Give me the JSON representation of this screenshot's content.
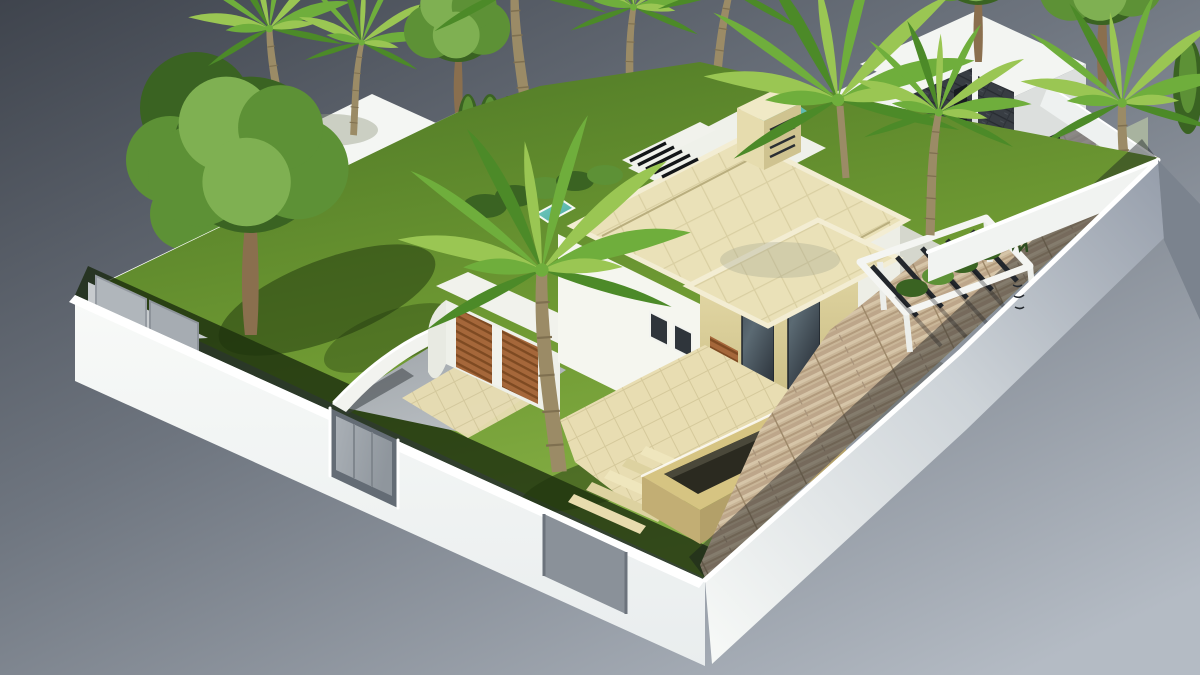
{
  "scene": {
    "alt": "Aerial isometric 3D architectural rendering of a modern Mediterranean villa plot: cream limestone villa with flat roofs, front lawn with palm trees, curved driveway to twin wooden garage doors, stone entry steps, raised stone water trough, long plank-paved driveway with white pergola, all enclosed by a white perimeter wall; white neighbouring houses with dark slate accents and many palms behind, floating on a grey studio gradient background"
  },
  "colors": {
    "bg_top_left": "#3f444d",
    "bg_mid": "#6e757f",
    "bg_bottom_right": "#b4bbc4",
    "perimeter_wall": "#f8faf8",
    "wall_shadow_face": "#959daa",
    "wall_top_highlight": "#ffffff",
    "inner_wall_face": "#dde2e6",
    "lawn_dark": "#4e7826",
    "lawn_light": "#8cb54a",
    "cast_shadow_green": "#16250b",
    "concrete_drive": "#b9bec2",
    "stone_paving": "#e8ddb2",
    "plank_paving": "#c9b698",
    "villa_render_white": "#f5f6ef",
    "villa_render_shade": "#e4e5d9",
    "limestone": "#e7dcab",
    "limestone_shade": "#c9bc83",
    "roof_stone": "#eae1b8",
    "glass": "#323a42",
    "glass_reflection": "#5b6a73",
    "window_frame": "#f2f3ef",
    "wood_door": "#a5673a",
    "pergola_slat": "#23272c",
    "planter_stone": "#d6c482",
    "water_dark": "#2b2a20",
    "pool_teal": "#74cfc4",
    "slate_wall": "#383d43",
    "sage_door": "#a8b39f",
    "neighbor_house_white": "#f3f5f2",
    "neighbor_house_face": "#dcdfdd",
    "shadow_drive": "#73757b",
    "terrace_grey": "#ccd1d4",
    "gate_metal": "#aab0b6",
    "gate_recess": "#646c75",
    "palm_light": "#9ac653",
    "palm_mid": "#6fae3c",
    "palm_dark": "#4c8a28",
    "tree_light": "#7fb052",
    "tree_mid": "#5d9136",
    "tree_dark": "#3a6322",
    "trunk": "#9b8b66",
    "tree_trunk": "#8a6f4e"
  }
}
